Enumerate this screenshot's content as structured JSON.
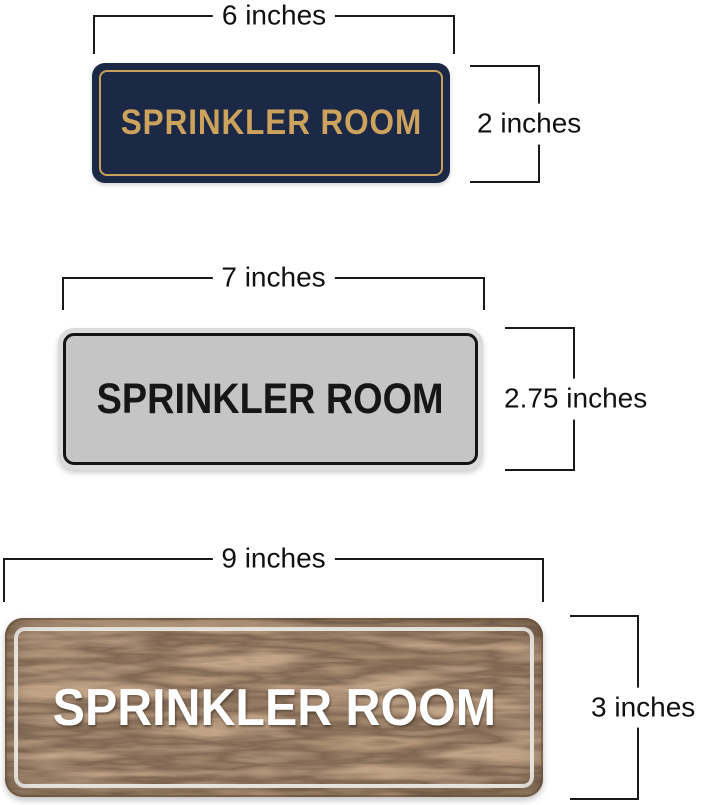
{
  "signs": [
    {
      "style": "navy-gold",
      "label": "SPRINKLER ROOM",
      "width_label": "6 inches",
      "height_label": "2 inches",
      "colors": {
        "background": "#1b2946",
        "border": "#c8a05a",
        "text": "#cda25d"
      }
    },
    {
      "style": "silver-black",
      "label": "SPRINKLER ROOM",
      "width_label": "7 inches",
      "height_label": "2.75 inches",
      "colors": {
        "background": "#c5c5c5",
        "frame": "#dbdbdb",
        "border": "#141414",
        "text": "#161616"
      }
    },
    {
      "style": "walnut-white",
      "label": "SPRINKLER ROOM",
      "width_label": "9 inches",
      "height_label": "3 inches",
      "colors": {
        "wood_mid": "#5e4733",
        "wood_dark": "#362619",
        "wood_light": "#7a5c41",
        "border": "#f7f4ef",
        "text": "#ffffff"
      }
    }
  ],
  "dimension_style": {
    "line_color": "#1a1a1a",
    "label_color": "#111111",
    "background": "#ffffff"
  }
}
